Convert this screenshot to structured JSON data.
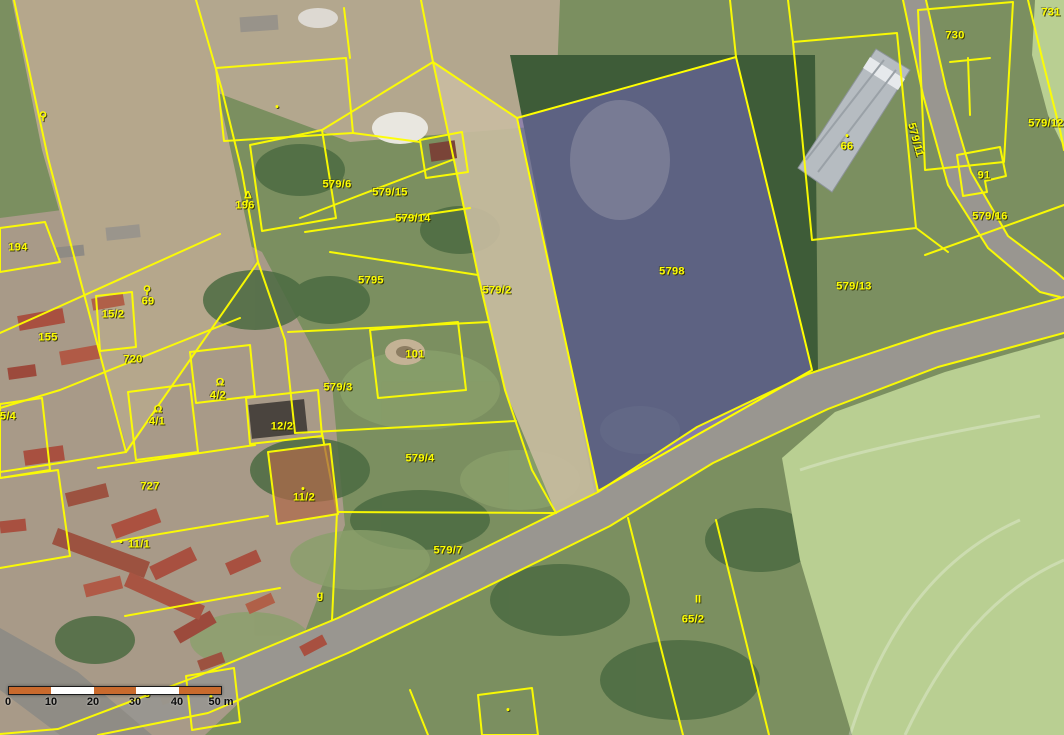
{
  "map": {
    "description": "Aerial orthophoto with cadastral parcel overlay",
    "boundary_color": "#ffff00",
    "label_color": "#ffff00",
    "selected_parcel": {
      "number": "5798",
      "fill": "#7668c0"
    }
  },
  "parcel_labels": [
    {
      "text": "731",
      "x": 1051,
      "y": 13
    },
    {
      "text": "730",
      "x": 955,
      "y": 36
    },
    {
      "text": "579/11",
      "x": 915,
      "y": 140,
      "rotate": 75
    },
    {
      "text": "579/12",
      "x": 1046,
      "y": 124
    },
    {
      "text": "91",
      "x": 984,
      "y": 176
    },
    {
      "text": "579/16",
      "x": 990,
      "y": 217
    },
    {
      "text": "66",
      "x": 847,
      "y": 147
    },
    {
      "text": "579/13",
      "x": 854,
      "y": 287
    },
    {
      "text": "5798",
      "x": 672,
      "y": 272
    },
    {
      "text": "579/6",
      "x": 337,
      "y": 185
    },
    {
      "text": "579/15",
      "x": 390,
      "y": 193
    },
    {
      "text": "579/14",
      "x": 413,
      "y": 219
    },
    {
      "text": "5795",
      "x": 371,
      "y": 281
    },
    {
      "text": "579/2",
      "x": 497,
      "y": 291
    },
    {
      "text": "196",
      "x": 245,
      "y": 206
    },
    {
      "text": "194",
      "x": 18,
      "y": 248
    },
    {
      "text": "69",
      "x": 148,
      "y": 302
    },
    {
      "text": "15/2",
      "x": 113,
      "y": 315
    },
    {
      "text": "155",
      "x": 48,
      "y": 338
    },
    {
      "text": "720",
      "x": 133,
      "y": 360
    },
    {
      "text": "101",
      "x": 415,
      "y": 355
    },
    {
      "text": "579/3",
      "x": 338,
      "y": 388
    },
    {
      "text": "4/2",
      "x": 218,
      "y": 396
    },
    {
      "text": "4/1",
      "x": 157,
      "y": 422
    },
    {
      "text": "12/2",
      "x": 282,
      "y": 427
    },
    {
      "text": "5/4",
      "x": 8,
      "y": 417
    },
    {
      "text": "579/4",
      "x": 420,
      "y": 459
    },
    {
      "text": "727",
      "x": 150,
      "y": 487
    },
    {
      "text": "11/2",
      "x": 304,
      "y": 498
    },
    {
      "text": "11/1",
      "x": 139,
      "y": 545
    },
    {
      "text": "579/7",
      "x": 448,
      "y": 551
    },
    {
      "text": "65/2",
      "x": 693,
      "y": 620
    }
  ],
  "map_symbols": [
    {
      "name": "pin-symbol",
      "glyph": "⚲",
      "x": 43,
      "y": 117
    },
    {
      "name": "triangle-symbol",
      "glyph": "Δ",
      "x": 248,
      "y": 196
    },
    {
      "name": "well-symbol",
      "glyph": "⚲",
      "x": 147,
      "y": 291
    },
    {
      "name": "omega-symbol",
      "glyph": "Ω",
      "x": 220,
      "y": 383
    },
    {
      "name": "omega-symbol",
      "glyph": "Ω",
      "x": 158,
      "y": 410
    },
    {
      "name": "scrub-symbol",
      "glyph": "II",
      "x": 698,
      "y": 600
    },
    {
      "name": "g-symbol",
      "glyph": "g",
      "x": 320,
      "y": 596
    },
    {
      "name": "g-symbol",
      "glyph": "g",
      "x": 147,
      "y": 692
    },
    {
      "name": "dot-symbol",
      "glyph": "●",
      "x": 277,
      "y": 107,
      "dot": true
    },
    {
      "name": "dot-symbol",
      "glyph": "●",
      "x": 847,
      "y": 136,
      "dot": true
    },
    {
      "name": "dot-symbol",
      "glyph": "●",
      "x": 303,
      "y": 489,
      "dot": true
    },
    {
      "name": "dot-symbol",
      "glyph": "●",
      "x": 211,
      "y": 697,
      "dot": true
    },
    {
      "name": "dot-symbol",
      "glyph": "●",
      "x": 508,
      "y": 710,
      "dot": true
    },
    {
      "name": "dot-symbol",
      "glyph": "●",
      "x": 121,
      "y": 542,
      "dot": true
    }
  ],
  "scale_bar": {
    "bar": {
      "x": 8,
      "y": 686,
      "width": 212,
      "height": 7
    },
    "segments": [
      "#c96a2d",
      "#ffffff",
      "#c96a2d",
      "#ffffff",
      "#c96a2d"
    ],
    "ticks": [
      {
        "label": "0",
        "x": 8
      },
      {
        "label": "10",
        "x": 51
      },
      {
        "label": "20",
        "x": 93
      },
      {
        "label": "30",
        "x": 135
      },
      {
        "label": "40",
        "x": 177
      },
      {
        "label": "50 m",
        "x": 221
      }
    ]
  }
}
